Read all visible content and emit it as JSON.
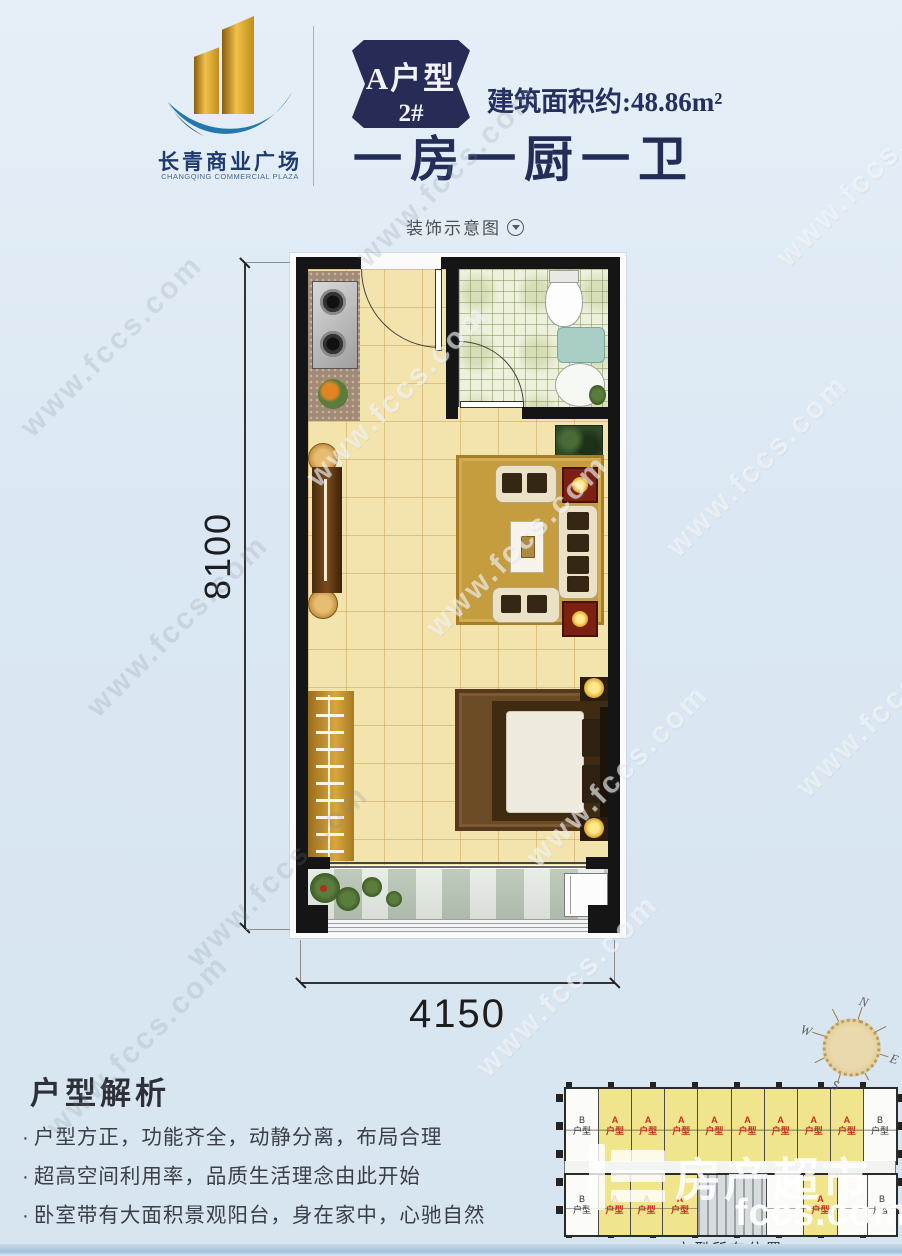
{
  "header": {
    "logo": {
      "name": "长青商业广场",
      "subtitle": "CHANGQING COMMERCIAL PLAZA"
    },
    "badge": {
      "line1": "A户型",
      "line2": "2#"
    },
    "area": "建筑面积约:48.86m²",
    "title": "一房一厨一卫"
  },
  "decor": {
    "label": "装饰示意图"
  },
  "plan": {
    "dim_height": "8100",
    "dim_width": "4150"
  },
  "analysis": {
    "title": "户型解析",
    "marker": "·",
    "bullets": [
      "户型方正，功能齐全，动静分离，布局合理",
      "超高空间利用率，品质生活理念由此开始",
      "卧室带有大面积景观阳台，身在家中，心驰自然"
    ]
  },
  "location": {
    "caption": "户型所在位置",
    "unit_a": "A\n户型",
    "unit_b": "B\n户型"
  },
  "compass": {
    "n": "N",
    "e": "E",
    "s": "S",
    "w": "W"
  },
  "watermark": {
    "diagonal": "www.fccs.com",
    "brand": "房产超市",
    "domain": "fccs.com"
  },
  "colors": {
    "accent_navy": "#262c56",
    "floor_beige": "#f3e3ad",
    "unit_yellow": "#f0e48c",
    "unit_label_red": "#c52f1d",
    "background_blue": "#dbe8f3"
  }
}
